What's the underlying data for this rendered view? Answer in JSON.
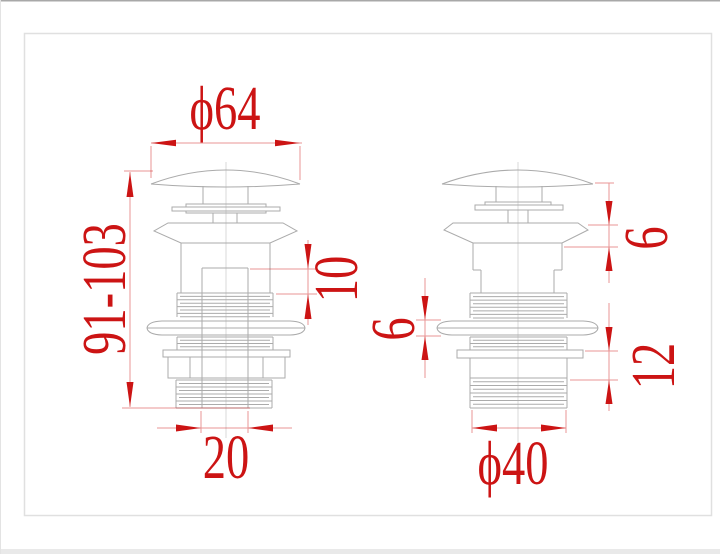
{
  "drawing": {
    "colors": {
      "dimension_red": "#cc1414",
      "outline_gray": "#ababab",
      "frame_gray": "#e0e0e0"
    },
    "views": {
      "left": {
        "dims": {
          "cap_diameter": {
            "label": "ϕ64"
          },
          "overall_height": {
            "label": "91-103"
          },
          "step_height": {
            "label": "10"
          },
          "inner_width": {
            "label": "20"
          }
        }
      },
      "right": {
        "dims": {
          "flange_height": {
            "label": "6"
          },
          "locknut_height": {
            "label": "6"
          },
          "washer_to_thread": {
            "label": "12"
          },
          "thread_diameter": {
            "label": "ϕ40"
          }
        }
      }
    }
  }
}
